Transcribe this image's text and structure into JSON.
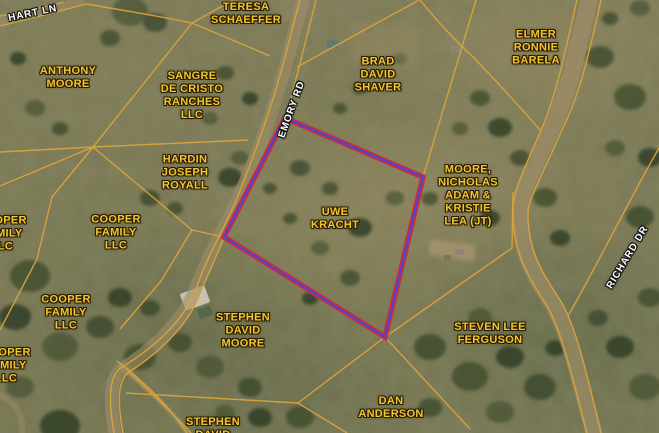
{
  "map": {
    "parcels": [
      {
        "label": "TERESA\nSCHAEFFER"
      },
      {
        "label": "ANTHONY\nMOORE"
      },
      {
        "label": "SANGRE\nDE CRISTO\nRANCHES\nLLC"
      },
      {
        "label": "BRAD\nDAVID\nSHAVER"
      },
      {
        "label": "ELMER\nRONNIE\nBARELA"
      },
      {
        "label": "HARDIN\nJOSEPH\nROYALL"
      },
      {
        "label": "MOORE,\nNICHOLAS\nADAM &\nKRISTIE\nLEA (JT)"
      },
      {
        "label": "UWE\nKRACHT"
      },
      {
        "label": "COOPER\nFAMILY\nLLC"
      },
      {
        "label": "COOPER\nFAMILY\nLLC"
      },
      {
        "label": "COOPER\nFAMILY\nLLC"
      },
      {
        "label": "COOPER\nFAMILY\nLLC"
      },
      {
        "label": "STEPHEN\nDAVID\nMOORE"
      },
      {
        "label": "STEVEN LEE\nFERGUSON"
      },
      {
        "label": "DAN\nANDERSON"
      },
      {
        "label": "STEPHEN\nDAVID"
      }
    ],
    "roads": [
      {
        "label": "HART LN"
      },
      {
        "label": "EMORY RD"
      },
      {
        "label": "RICHARD DR"
      }
    ],
    "highlighted_parcel": {
      "owner": "UWE KRACHT",
      "points": "285,118 423,177 385,337 224,237",
      "outline_outer_color": "#d22a36",
      "outline_inner_color": "#5345c6"
    },
    "colors": {
      "parcel_line": "#d9a33b",
      "parcel_label": "#f3c430",
      "road_label": "#ffffff"
    }
  }
}
